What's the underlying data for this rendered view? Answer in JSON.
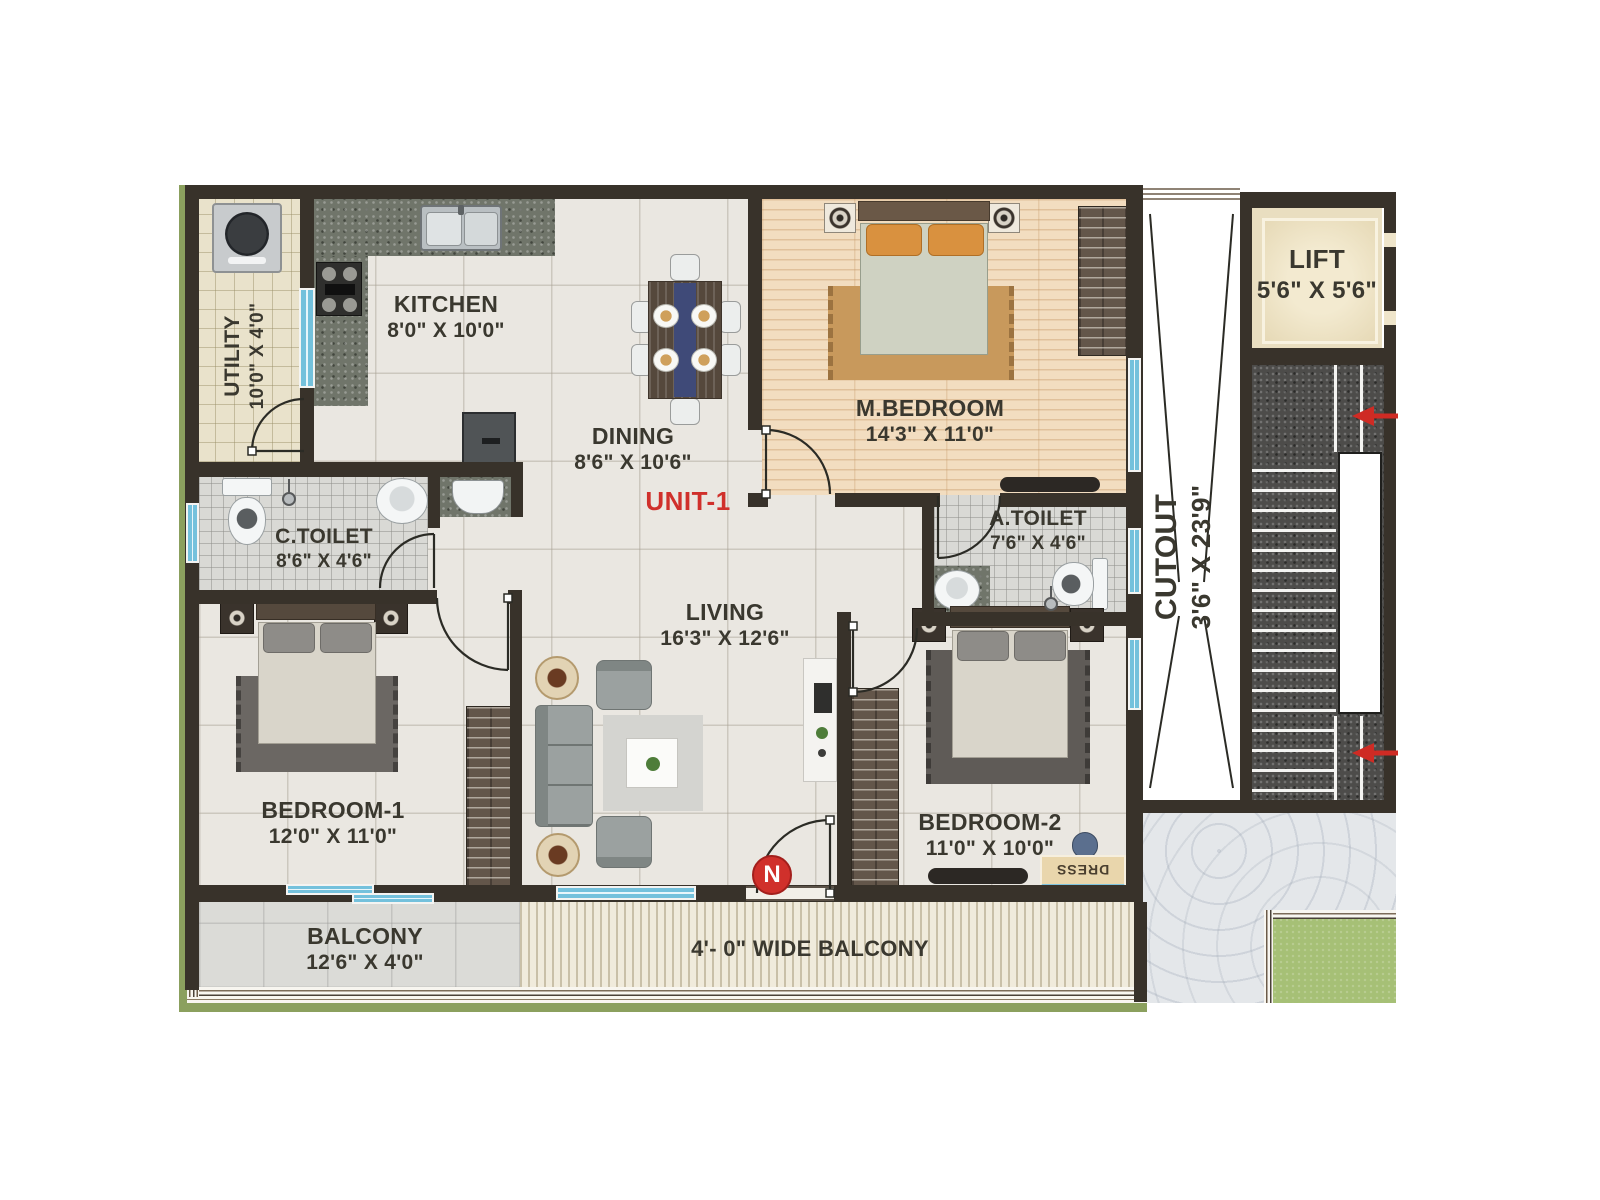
{
  "unit": {
    "label": "UNIT-1"
  },
  "north": {
    "label": "N"
  },
  "rooms": {
    "utility": {
      "name": "UTILITY",
      "dims": "10'0\" X 4'0\""
    },
    "kitchen": {
      "name": "KITCHEN",
      "dims": "8'0\" X 10'0\""
    },
    "dining": {
      "name": "DINING",
      "dims": "8'6\" X 10'6\""
    },
    "master_bedroom": {
      "name": "M.BEDROOM",
      "dims": "14'3\" X 11'0\""
    },
    "common_toilet": {
      "name": "C.TOILET",
      "dims": "8'6\" X 4'6\""
    },
    "attached_toilet": {
      "name": "A.TOILET",
      "dims": "7'6\" X 4'6\""
    },
    "living": {
      "name": "LIVING",
      "dims": "16'3\" X 12'6\""
    },
    "bedroom1": {
      "name": "BEDROOM-1",
      "dims": "12'0\" X 11'0\""
    },
    "bedroom2": {
      "name": "BEDROOM-2",
      "dims": "11'0\" X 10'0\""
    },
    "balcony": {
      "name": "BALCONY",
      "dims": "12'6\" X 4'0\""
    },
    "wide_balcony": {
      "name": "4'- 0\" WIDE BALCONY"
    },
    "lift": {
      "name": "LIFT",
      "dims": "5'6\" X 5'6\""
    },
    "cutout": {
      "name": "CUTOUT",
      "dims": "3'6\" X 23'9\""
    }
  },
  "furniture": {
    "dress_label": "DRESS"
  },
  "colors": {
    "wall": "#38322a",
    "accent_red": "#d0302b",
    "window_blue": "#74c1dc",
    "wood_floor": "#f2ddc0",
    "lift_floor": "#e9dec0",
    "lawn_green": "#a6c076",
    "marble": "#e4e7ea"
  }
}
